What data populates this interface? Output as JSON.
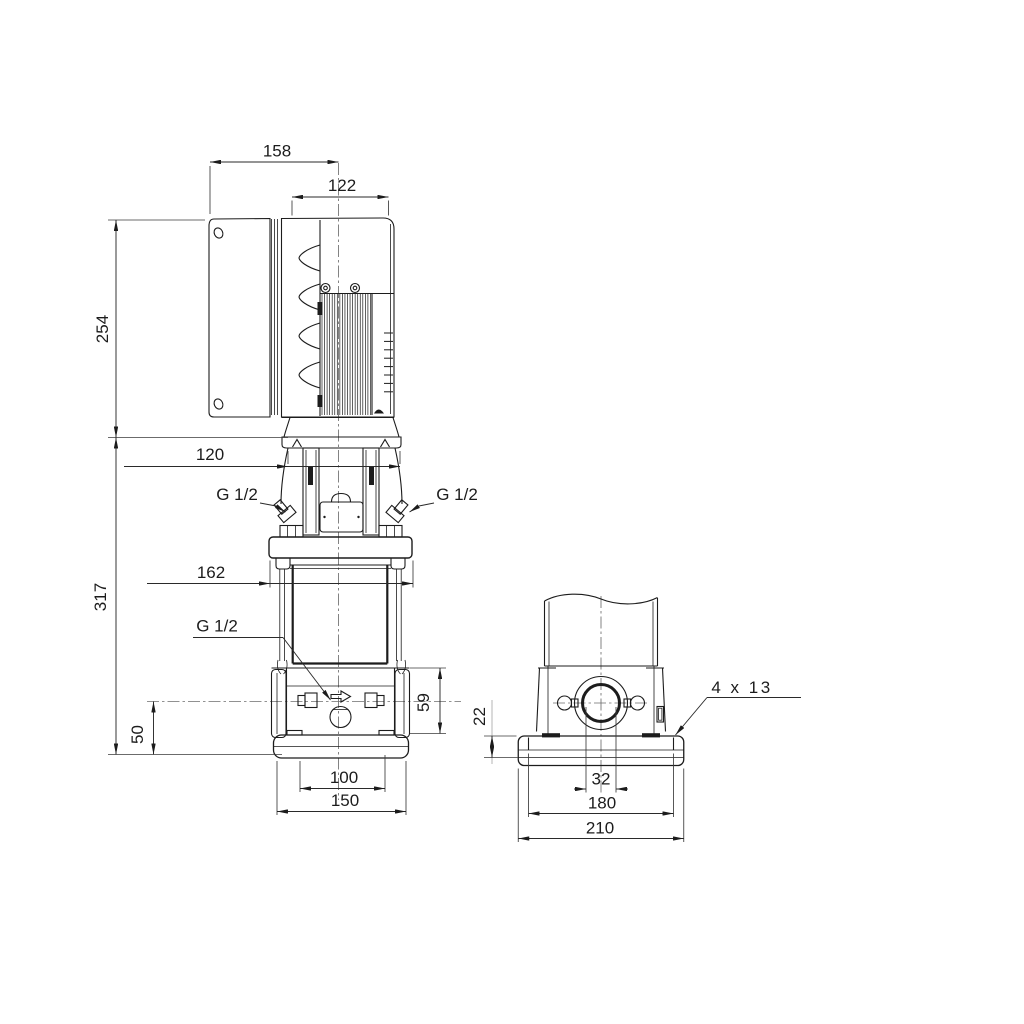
{
  "side_view": {
    "dims": {
      "top_width": "158",
      "motor_width": "122",
      "motor_height": "254",
      "stool_width": "120",
      "pump_height": "317",
      "flange_width": "162",
      "port_section_height": "59",
      "base_height": "50",
      "foot_hole_spacing": "100",
      "foot_width": "150"
    },
    "plugs": {
      "top_left": "G 1/2",
      "top_right": "G 1/2",
      "drain": "G 1/2"
    }
  },
  "front_view": {
    "dims": {
      "baseplate_step": "22",
      "port_bore": "32",
      "bolt_spacing": "180",
      "baseplate_width": "210"
    },
    "bolt_holes_note": "4 x 13"
  },
  "colors": {
    "line": "#1c1c1c",
    "background": "#ffffff"
  }
}
